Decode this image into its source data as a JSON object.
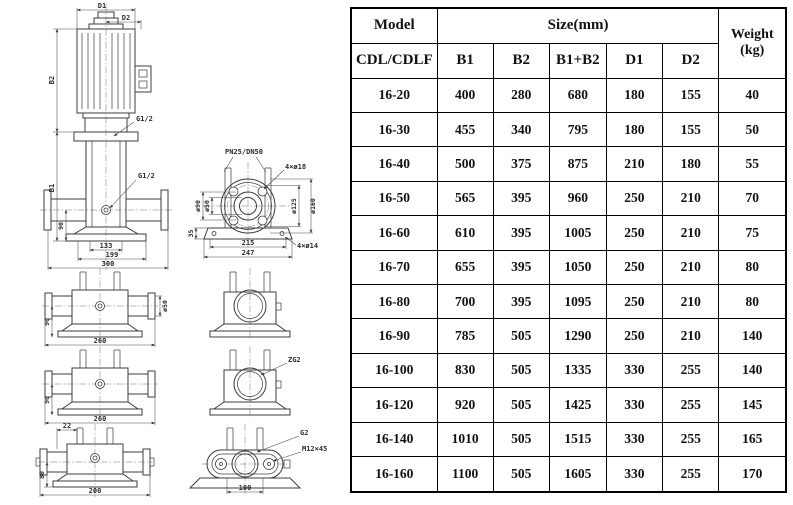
{
  "drawing": {
    "main_view": {
      "d1": "D1",
      "d2": "D2",
      "b1": "B1",
      "b2": "B2",
      "h90": "90",
      "w133": "133",
      "w199": "199",
      "w300": "300",
      "port_top": "G1/2",
      "port_mid": "G1/2"
    },
    "flange_view": {
      "title": "PN25/DN50",
      "bolts_top": "4×ø18",
      "bolts_bottom": "4×ø14",
      "dia_hub": "ø90",
      "dia_bore": "ø50",
      "dia_bolt_circle": "ø125",
      "dia_outer": "ø160",
      "h35": "35",
      "w215": "215",
      "w247": "247"
    },
    "suction_view_1": {
      "h90": "90",
      "w260": "260",
      "dia_port": "ø50"
    },
    "suction_view_2": {
      "h90": "90",
      "w260": "260"
    },
    "port_view": {
      "label": "ZG2"
    },
    "bottom_view": {
      "w22": "22",
      "h80": "80",
      "w200": "200"
    },
    "oval_flange_view": {
      "thread": "G2",
      "bolt": "M12×45",
      "w100": "100"
    }
  },
  "table": {
    "header": {
      "model": "Model",
      "model_sub": "CDL/CDLF",
      "size_group": "Size(mm)",
      "size_cols": [
        "B1",
        "B2",
        "B1+B2",
        "D1",
        "D2"
      ],
      "weight_line1": "Weight",
      "weight_line2": "(kg)"
    },
    "rows": [
      [
        "16-20",
        "400",
        "280",
        "680",
        "180",
        "155",
        "40"
      ],
      [
        "16-30",
        "455",
        "340",
        "795",
        "180",
        "155",
        "50"
      ],
      [
        "16-40",
        "500",
        "375",
        "875",
        "210",
        "180",
        "55"
      ],
      [
        "16-50",
        "565",
        "395",
        "960",
        "250",
        "210",
        "70"
      ],
      [
        "16-60",
        "610",
        "395",
        "1005",
        "250",
        "210",
        "75"
      ],
      [
        "16-70",
        "655",
        "395",
        "1050",
        "250",
        "210",
        "80"
      ],
      [
        "16-80",
        "700",
        "395",
        "1095",
        "250",
        "210",
        "80"
      ],
      [
        "16-90",
        "785",
        "505",
        "1290",
        "250",
        "210",
        "140"
      ],
      [
        "16-100",
        "830",
        "505",
        "1335",
        "330",
        "255",
        "140"
      ],
      [
        "16-120",
        "920",
        "505",
        "1425",
        "330",
        "255",
        "145"
      ],
      [
        "16-140",
        "1010",
        "505",
        "1515",
        "330",
        "255",
        "165"
      ],
      [
        "16-160",
        "1100",
        "505",
        "1605",
        "330",
        "255",
        "170"
      ]
    ]
  },
  "colors": {
    "line": "#3c3c3c",
    "border": "#000000",
    "background": "#ffffff"
  }
}
